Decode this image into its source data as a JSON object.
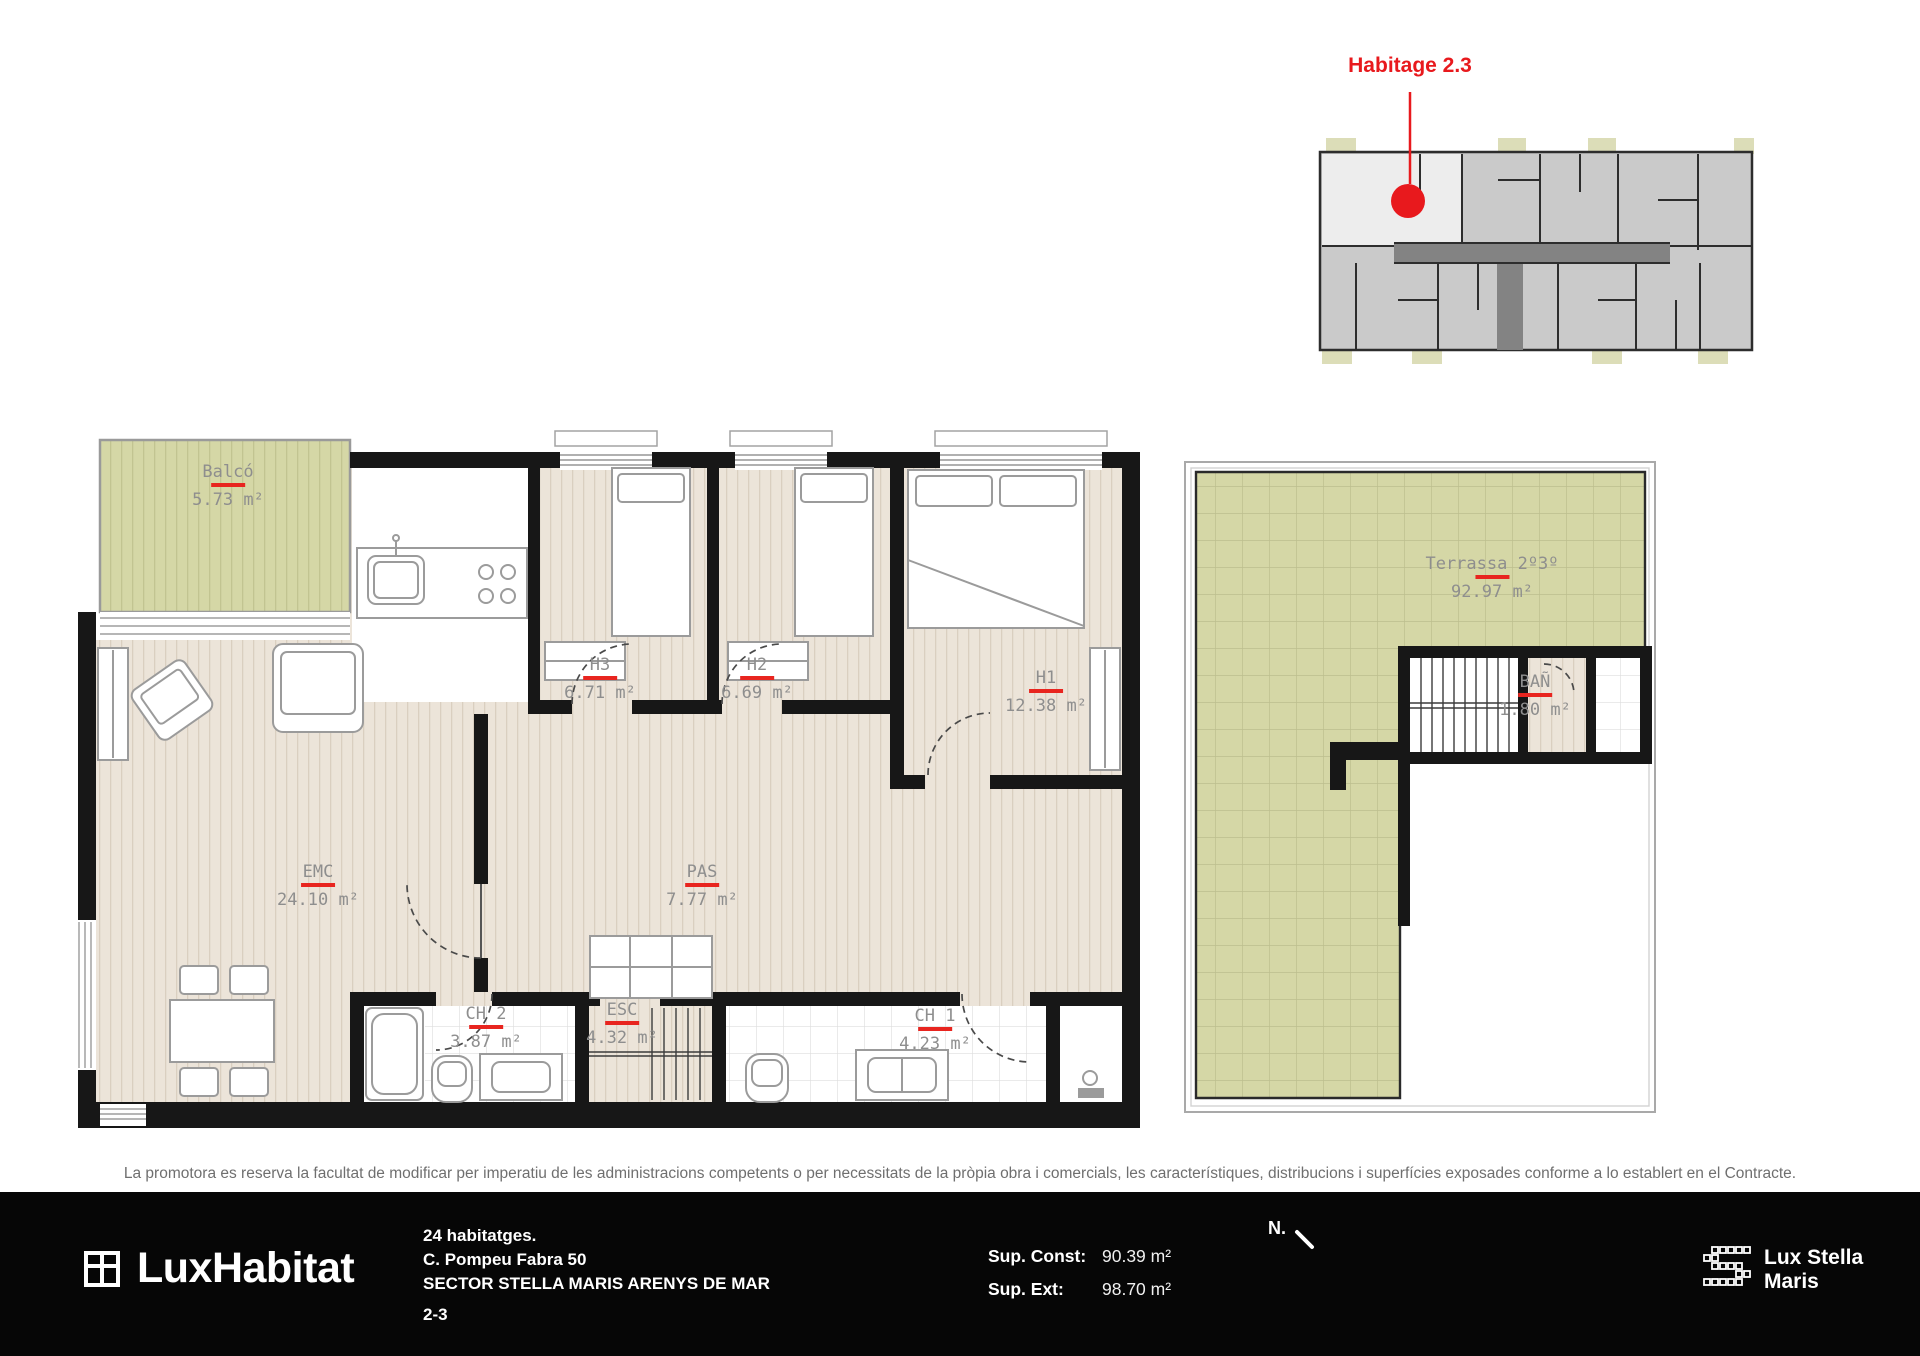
{
  "page": {
    "unit_callout": "Habitage 2.3",
    "disclaimer": "La promotora es reserva la facultat de modificar per imperatiu de les administracions competents o per necessitats de la pròpia obra i comercials, les característiques, distribucions i superfícies exposades conforme a lo establert en el Contracte."
  },
  "plan": {
    "rooms": [
      {
        "name": "Balcó",
        "area": "5.73 m²"
      },
      {
        "name": "H3",
        "area": "6.71 m²"
      },
      {
        "name": "H2",
        "area": "6.69 m²"
      },
      {
        "name": "H1",
        "area": "12.38 m²"
      },
      {
        "name": "EMC",
        "area": "24.10 m²"
      },
      {
        "name": "PAS",
        "area": "7.77 m²"
      },
      {
        "name": "CH 2",
        "area": "3.87 m²"
      },
      {
        "name": "ESC",
        "area": "4.32 m²"
      },
      {
        "name": "CH 1",
        "area": "4.23 m²"
      },
      {
        "name": "Terrassa 2º3º",
        "area": "92.97 m²"
      },
      {
        "name": "BAÑ",
        "area": "1.80 m²"
      }
    ]
  },
  "footer": {
    "brand": "LuxHabitat",
    "project_lines": [
      "24 habitatges.",
      "C. Pompeu Fabra 50",
      "SECTOR STELLA MARIS ARENYS DE MAR",
      "2-3"
    ],
    "sup_const_label": "Sup. Const:",
    "sup_const_value": "90.39 m²",
    "sup_ext_label": "Sup. Ext:",
    "sup_ext_value": "98.70 m²",
    "north_label": "N.",
    "partner_line1": "Lux Stella",
    "partner_line2": "Maris"
  },
  "colors": {
    "accent_red": "#e8191d",
    "olive": "#d5d7a6",
    "wall": "#171717",
    "label_gray": "#8e8e8e"
  }
}
